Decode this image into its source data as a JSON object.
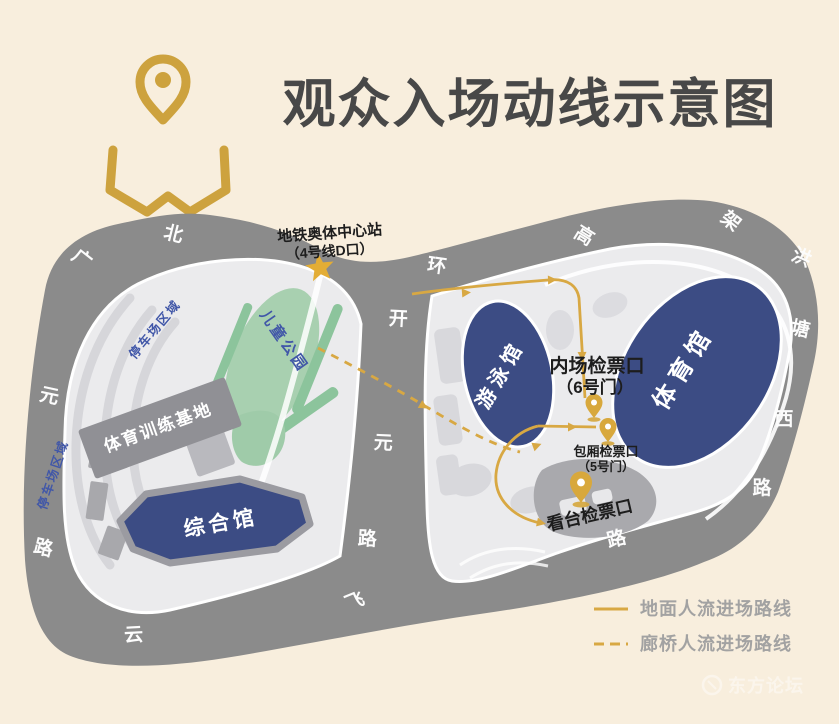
{
  "header": {
    "title": "观众入场动线示意图"
  },
  "map": {
    "station": {
      "name": "地铁奥体中心站",
      "exit": "（4号线D口）"
    },
    "venues": {
      "swimming_hall": "游泳馆",
      "gymnasium": "体育馆",
      "multi_hall": "综合馆",
      "training_base": "体育训练基地",
      "children_park": "儿童公园",
      "parking_area_1": "停车场区域",
      "parking_area_2": "停车场区域"
    },
    "checkpoints": {
      "infield": {
        "name": "内场检票口",
        "gate": "（6号门）"
      },
      "box": {
        "name": "包厢检票口",
        "gate": "（5号门）"
      },
      "stands": {
        "name": "看台检票口"
      }
    },
    "road_labels": [
      {
        "text": "北"
      },
      {
        "text": "广"
      },
      {
        "text": "元"
      },
      {
        "text": "路"
      },
      {
        "text": "环"
      },
      {
        "text": "开"
      },
      {
        "text": "元"
      },
      {
        "text": "路"
      },
      {
        "text": "飞"
      },
      {
        "text": "云"
      },
      {
        "text": "路"
      },
      {
        "text": "高"
      },
      {
        "text": "架"
      },
      {
        "text": "洪"
      },
      {
        "text": "塘"
      },
      {
        "text": "西"
      },
      {
        "text": "路"
      }
    ]
  },
  "legend": {
    "ground_route": "地面人流进场路线",
    "bridge_route": "廊桥人流进场路线"
  },
  "watermark": {
    "text": "东方论坛"
  },
  "colors": {
    "background": "#f8eedd",
    "road_gray": "#8b8b8b",
    "island_gray": "#ebebed",
    "venue_navy": "#3c4c84",
    "park_green": "#a8d0b0",
    "accent_gold": "#d5a63c",
    "label_blue": "#4157a8",
    "title_gray": "#484848"
  }
}
